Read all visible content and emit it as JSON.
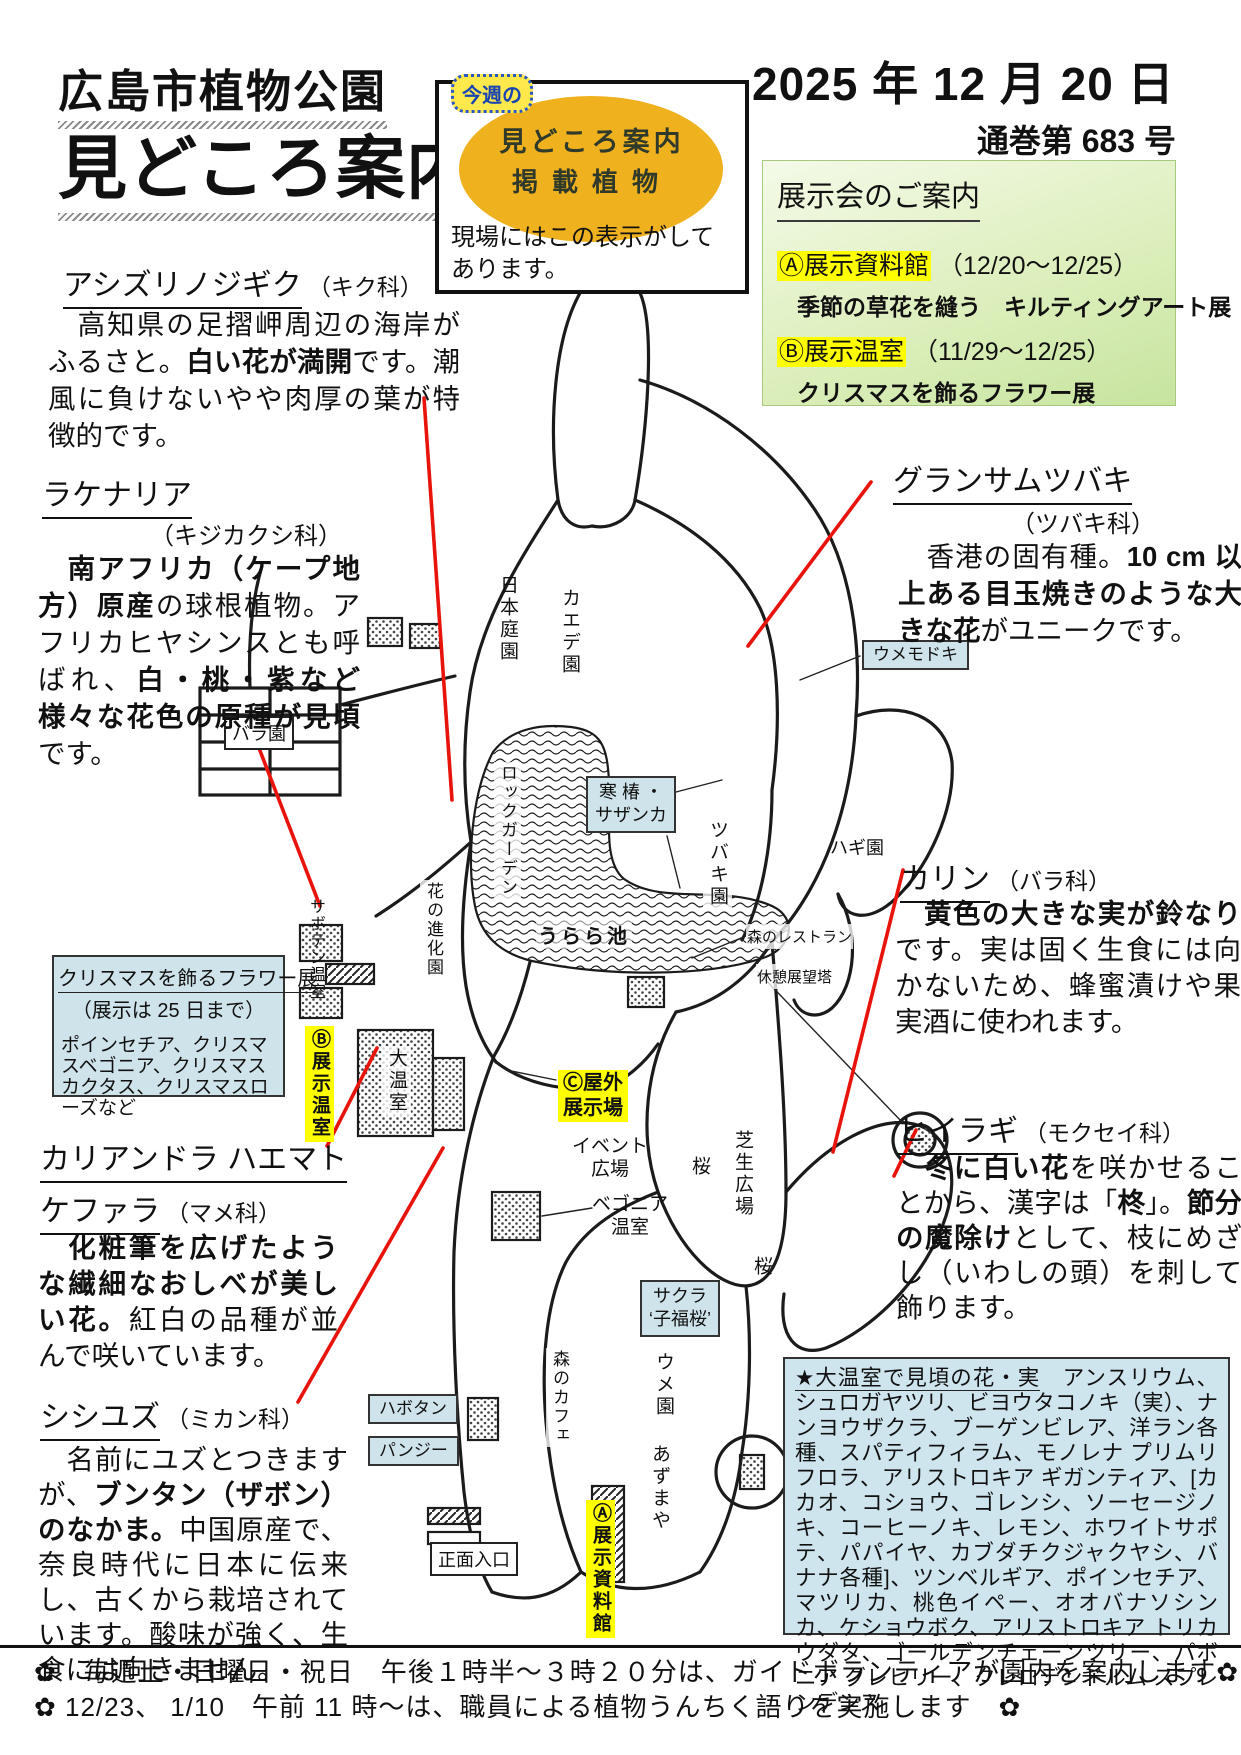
{
  "header": {
    "org": "広島市植物公園",
    "title": "見どころ案内",
    "date": "2025 年 12 月 20 日",
    "issue": "通巻第 683 号"
  },
  "badge": {
    "week": "今週の",
    "line1": "見どころ案内",
    "line2": "掲載植物",
    "caption": "現場にはこの表示がしてあります。"
  },
  "exhibitions": {
    "heading": "展示会のご案内",
    "items": [
      {
        "venue": "Ⓐ展示資料館",
        "dates": "（12/20～12/25）",
        "title": "季節の草花を縫う　キルティングアート展"
      },
      {
        "venue": "Ⓑ展示温室",
        "dates": "（11/29～12/25）",
        "title": "クリスマスを飾るフラワー展"
      }
    ]
  },
  "articles": {
    "ashizuri": {
      "name": "アシズリノジギク",
      "family": "（キク科）",
      "b": [
        "　高知県の足摺岬周辺の海岸がふるさと。",
        "白い花が満開",
        "です。潮風に負けないやや肉厚の葉が特徴的です。"
      ]
    },
    "lachenalia": {
      "name": "ラケナリア",
      "family": "（キジカクシ科）",
      "b": [
        "　",
        "南アフリカ（ケープ地方）原産",
        "の球根植物。アフリカヒヤシンスとも呼ばれ、",
        "白・桃・紫など様々な花色の原種が見頃",
        "です。"
      ]
    },
    "grantham": {
      "name": "グランサムツバキ",
      "family": "（ツバキ科）",
      "b": [
        "　香港の固有種。",
        "10 cm 以上ある目玉焼きのような大きな花",
        "がユニークです。"
      ]
    },
    "karin": {
      "name": "カリン",
      "family": "（バラ科）",
      "b": [
        "　",
        "黄色の大きな実が鈴なり",
        "です。実は固く生食には向かないため、蜂蜜漬けや果実酒に使われます。"
      ]
    },
    "hiiragi": {
      "name": "ヒイラギ",
      "family": "（モクセイ科）",
      "b": [
        "　",
        "冬に白い花",
        "を咲かせることから、漢字は「",
        "柊",
        "」。",
        "節分の魔除け",
        "として、枝にめざし（いわしの頭）を刺して飾ります。"
      ]
    },
    "calliandra": {
      "name1": "カリアンドラ ハエマト",
      "name2": "ケファラ",
      "family": "（マメ科）",
      "b": [
        "　",
        "化粧筆を広げたような繊細なおしべが美しい花。",
        "紅白の品種が並んで咲いています。"
      ]
    },
    "shishiyuzu": {
      "name": "シシユズ",
      "family": "（ミカン科）",
      "b": [
        "　名前にユズとつきますが、",
        "ブンタン（ザボン）のなかま。",
        "中国原産で、奈良時代に日本に伝来し、古くから栽培されています。酸味が強く、生食には向きません。"
      ]
    }
  },
  "flower_show_box": {
    "title": "クリスマスを飾るフラワー展",
    "subtitle": "（展示は 25 日まで）",
    "body": "ポインセチア、クリスマスベゴニア、クリスマスカクタス、クリスマスローズなど"
  },
  "greenhouse_box": {
    "heading": "★大温室で見頃の花・実",
    "body": "　アンスリウム、シュロガヤツリ、ビヨウタコノキ（実）、ナンヨウザクラ、ブーゲンビレア、洋ラン各種、スパティフィラム、モノレナ プリムリフロラ、アリストロキア ギガンティア、[カカオ、コショウ、ゴレンシ、ソーセージノキ、コーヒーノキ、レモン、ホワイトサポテ、パパイヤ、カブダチクジャクヤシ、バナナ各種]、ツンベルギア、ポインセチア、マツリカ、桃色イペー、オオバナソシンカ、ケショウボク、アリストロキア トリカウダタ、ゴールデンチェーンツリー、パボニア グレヒリー、クレロデンドルム スプレンデンス"
  },
  "footer": {
    "line1": "✿　毎週土・日曜日・祝日　午後１時半～３時２０分は、ガイドボランティアが園内を案内します✿",
    "line2": "✿ 12/23、 1/10　午前 11 時～は、職員による植物うんちく語りを実施します　✿"
  },
  "map": {
    "labels": [
      {
        "id": "nihon-teien",
        "lines": [
          "日本庭園"
        ],
        "x": 494,
        "y": 575,
        "cls": "v"
      },
      {
        "id": "kaede-en",
        "lines": [
          "カエデ園"
        ],
        "x": 556,
        "y": 588,
        "cls": "v"
      },
      {
        "id": "bara-en",
        "lines": [
          "バラ園"
        ],
        "x": 224,
        "y": 716,
        "cls": "boxed"
      },
      {
        "id": "rock-garden",
        "lines": [
          "ロックガーデン"
        ],
        "x": 494,
        "y": 762,
        "cls": "v vs wbg"
      },
      {
        "id": "hana-no-shinka-en",
        "lines": [
          "花の進化園"
        ],
        "x": 420,
        "y": 880,
        "cls": "v vs wbg"
      },
      {
        "id": "urara-ike",
        "lines": [
          "うらら池"
        ],
        "x": 536,
        "y": 920,
        "cls": "outline"
      },
      {
        "id": "kanchubaki-sazanka",
        "lines": [
          "寒 椿 ・",
          "サザンカ"
        ],
        "x": 586,
        "y": 776,
        "cls": "bluebox"
      },
      {
        "id": "tsubaki-en",
        "lines": [
          "ツバキ園"
        ],
        "x": 703,
        "y": 818,
        "cls": "v wbg"
      },
      {
        "id": "umemodoki",
        "lines": [
          "ウメモドキ"
        ],
        "x": 862,
        "y": 640,
        "cls": "bluebox hbox"
      },
      {
        "id": "hagi-en",
        "lines": [
          "ハギ園"
        ],
        "x": 830,
        "y": 834,
        "cls": "plain"
      },
      {
        "id": "mori-no-restaurant",
        "lines": [
          "森のレストラン"
        ],
        "x": 746,
        "y": 924,
        "cls": "plain ps wbg"
      },
      {
        "id": "kyukei-tenbodai",
        "lines": [
          "休憩展望塔"
        ],
        "x": 756,
        "y": 964,
        "cls": "plain ps wbg"
      },
      {
        "id": "saboten-onshitsu",
        "lines": [
          "サボテン温室"
        ],
        "x": 303,
        "y": 898,
        "cls": "v vxs"
      },
      {
        "id": "b-tenji-onshitsu",
        "lines": [
          "Ⓑ展示温室"
        ],
        "x": 305,
        "y": 1026,
        "cls": "v ylab"
      },
      {
        "id": "dai-onshitsu",
        "lines": [
          "大温室"
        ],
        "x": 382,
        "y": 1046,
        "cls": "v wbg"
      },
      {
        "id": "c-okugai-tenjijo",
        "lines": [
          "Ⓒ屋外",
          "展示場"
        ],
        "x": 558,
        "y": 1070,
        "cls": "ylab2"
      },
      {
        "id": "event-hiroba",
        "lines": [
          "イベント",
          "広場"
        ],
        "x": 572,
        "y": 1136,
        "cls": "c2"
      },
      {
        "id": "sakura-north",
        "lines": [
          "桜"
        ],
        "x": 686,
        "y": 1156,
        "cls": "v"
      },
      {
        "id": "begonia-onshitsu",
        "lines": [
          "ベゴニア",
          "温室"
        ],
        "x": 592,
        "y": 1194,
        "cls": "c2"
      },
      {
        "id": "shibafu-hiroba",
        "lines": [
          "芝生広場"
        ],
        "x": 728,
        "y": 1128,
        "cls": "v wbg"
      },
      {
        "id": "sakura-south",
        "lines": [
          "桜"
        ],
        "x": 748,
        "y": 1256,
        "cls": "v"
      },
      {
        "id": "sakura-kofukuzakura",
        "lines": [
          "サクラ",
          "‘子福桜’"
        ],
        "x": 640,
        "y": 1280,
        "cls": "bluebox"
      },
      {
        "id": "ume-en",
        "lines": [
          "ウメ園"
        ],
        "x": 650,
        "y": 1352,
        "cls": "v"
      },
      {
        "id": "mori-no-cafe",
        "lines": [
          "森のカフェ"
        ],
        "x": 546,
        "y": 1348,
        "cls": "v vs wbg"
      },
      {
        "id": "habotan",
        "lines": [
          "ハボタン"
        ],
        "x": 368,
        "y": 1394,
        "cls": "bluebox hbox"
      },
      {
        "id": "pansy",
        "lines": [
          "パンジー"
        ],
        "x": 368,
        "y": 1436,
        "cls": "bluebox hbox"
      },
      {
        "id": "azumaya",
        "lines": [
          "あずまや"
        ],
        "x": 646,
        "y": 1444,
        "cls": "v"
      },
      {
        "id": "shomen-iriguchi",
        "lines": [
          "正面入口"
        ],
        "x": 430,
        "y": 1542,
        "cls": "boxed"
      },
      {
        "id": "a-tenji-shiryokan",
        "lines": [
          "Ⓐ展示資料館"
        ],
        "x": 586,
        "y": 1500,
        "cls": "v ylab"
      }
    ],
    "red_connectors": [
      {
        "id": "ashizuri",
        "x1": 424,
        "y1": 398,
        "x2": 452,
        "y2": 800
      },
      {
        "id": "lachenalia",
        "x1": 252,
        "y1": 730,
        "x2": 320,
        "y2": 906
      },
      {
        "id": "grantham",
        "x1": 871,
        "y1": 482,
        "x2": 748,
        "y2": 646
      },
      {
        "id": "karin",
        "x1": 903,
        "y1": 870,
        "x2": 833,
        "y2": 1152
      },
      {
        "id": "hiiragi",
        "x1": 894,
        "y1": 1176,
        "x2": 916,
        "y2": 1130
      },
      {
        "id": "calliandra",
        "x1": 377,
        "y1": 1048,
        "x2": 327,
        "y2": 1146
      },
      {
        "id": "shishiyuzu",
        "x1": 443,
        "y1": 1148,
        "x2": 298,
        "y2": 1402
      }
    ],
    "leaders": [
      {
        "id": "tsubaki-upper",
        "x1": 676,
        "y1": 792,
        "x2": 722,
        "y2": 780
      },
      {
        "id": "tsubaki-lower",
        "x1": 667,
        "y1": 836,
        "x2": 680,
        "y2": 888
      },
      {
        "id": "begonia",
        "x1": 592,
        "y1": 1208,
        "x2": 542,
        "y2": 1216
      },
      {
        "id": "okugai",
        "x1": 556,
        "y1": 1080,
        "x2": 506,
        "y2": 1070
      },
      {
        "id": "umemodoki",
        "x1": 860,
        "y1": 656,
        "x2": 800,
        "y2": 680
      },
      {
        "id": "restaurant",
        "x1": 746,
        "y1": 936,
        "x2": 692,
        "y2": 958
      },
      {
        "id": "tenbodai",
        "x1": 758,
        "y1": 972,
        "x2": 902,
        "y2": 1122
      }
    ]
  },
  "colors": {
    "red_connector": "#e8140c",
    "map_label_blue": "#cfe3ea",
    "highlight_yellow": "#ffff00",
    "green_box": "#d8edb6",
    "big_box_blue": "#cfe5ee",
    "badge_orange": "#f0b11e"
  }
}
